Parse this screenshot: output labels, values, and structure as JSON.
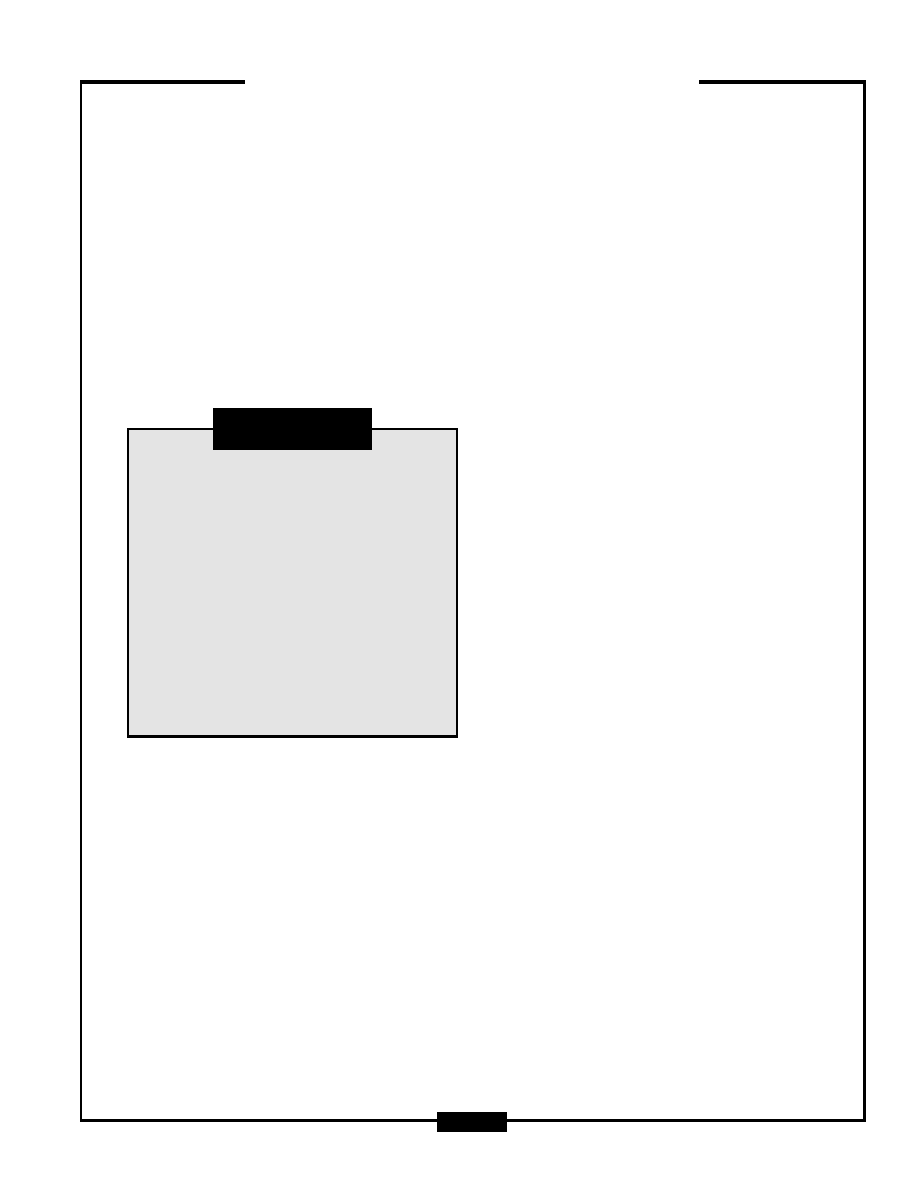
{
  "page": {
    "background": "#ffffff",
    "frame_color": "#000000"
  },
  "header": {
    "rule_color": "#000000"
  },
  "figure_box": {
    "fill": "#e4e4e4",
    "border_color": "#000000",
    "content_text": ""
  },
  "caption_bar": {
    "fill": "#000000",
    "text": ""
  },
  "footer": {
    "page_marker_fill": "#000000",
    "page_marker_text": ""
  }
}
